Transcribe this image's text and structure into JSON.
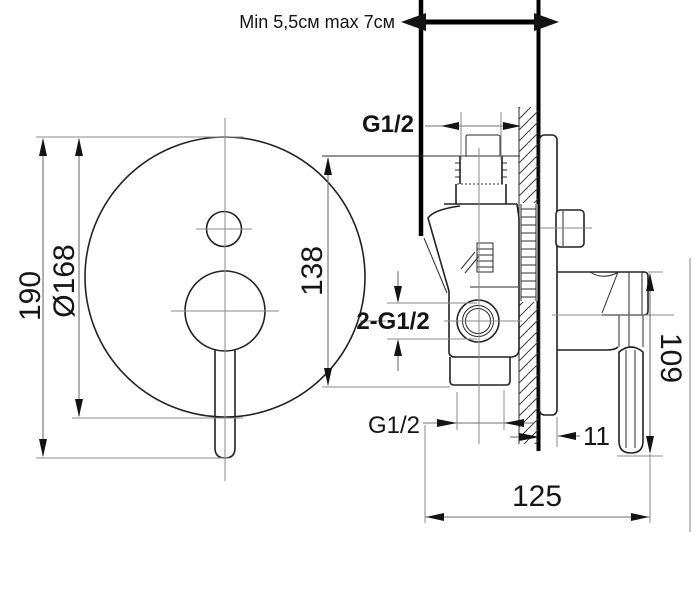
{
  "note": "Min 5,5см max 7см",
  "labels": {
    "g12_top": "G1/2",
    "g12_mid": "2-G1/2",
    "g12_bottom": "G1/2"
  },
  "dims": {
    "overall_height": "190",
    "plate_diameter": "Ø168",
    "port_height": "138",
    "handle_height": "109",
    "plate_offset": "11",
    "body_depth": "125"
  },
  "colors": {
    "outline": "#222222",
    "dim_line": "#8a8a8a",
    "text": "#151515",
    "background": "#ffffff"
  }
}
